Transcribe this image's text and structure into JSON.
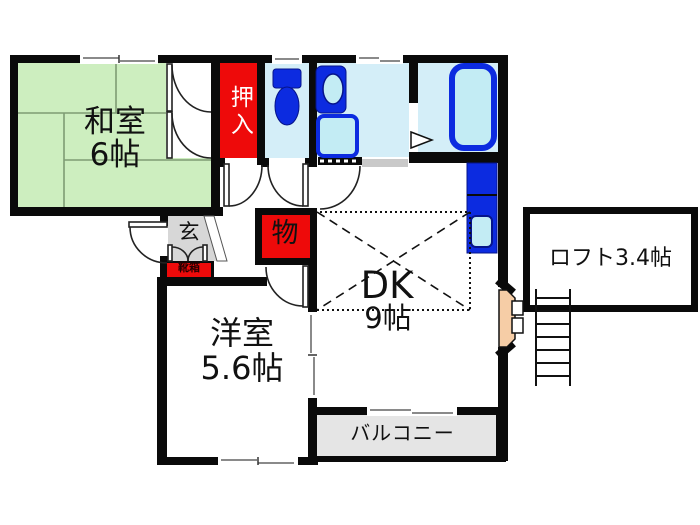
{
  "plan_type": "japanese_apartment_floor_plan",
  "labels": {
    "washitsu_l1": "和室",
    "washitsu_l2": "6帖",
    "oshiire": "押入",
    "genkan": "玄",
    "shoebox": "靴箱",
    "storage": "物",
    "dk_l1": "DK",
    "dk_l2": "9帖",
    "yoshitsu_l1": "洋室",
    "yoshitsu_l2": "5.6帖",
    "loft": "ロフト3.4帖",
    "balcony": "バルコニー"
  },
  "rooms": [
    {
      "name": "和室",
      "type": "japanese_room",
      "area_jo": 6
    },
    {
      "name": "押入",
      "type": "closet"
    },
    {
      "type": "toilet"
    },
    {
      "type": "washroom"
    },
    {
      "type": "bathroom"
    },
    {
      "name": "玄",
      "type": "entrance"
    },
    {
      "name": "靴箱",
      "type": "shoe_cabinet"
    },
    {
      "name": "物",
      "type": "storage"
    },
    {
      "name": "DK",
      "type": "dining_kitchen",
      "area_jo": 9
    },
    {
      "name": "洋室",
      "type": "western_room",
      "area_jo": 5.6
    },
    {
      "name": "ロフト",
      "type": "loft",
      "area_jo": 3.4
    },
    {
      "name": "バルコニー",
      "type": "balcony"
    }
  ],
  "fixtures": [
    "toilet",
    "vanity-sink",
    "washing-machine-pan",
    "bathtub",
    "kitchen-sink-unit",
    "loft-ladder",
    "entrance-door",
    "shoe-cabinet-doors",
    "bath-folding-door"
  ],
  "colors": {
    "wall": "#0a0a0a",
    "tatami_green": "#cdeebf",
    "tatami_line": "#7e9c74",
    "closet_red": "#ee0a0a",
    "wet_area_floor": "#d4eef8",
    "fixture_blue": "#0c2be0",
    "fixture_inner": "#c3ecf4",
    "genkan_gray": "#d7d7d7",
    "balcony_gray": "#e5e5e5",
    "entry_door_tan": "#f6cda6"
  }
}
